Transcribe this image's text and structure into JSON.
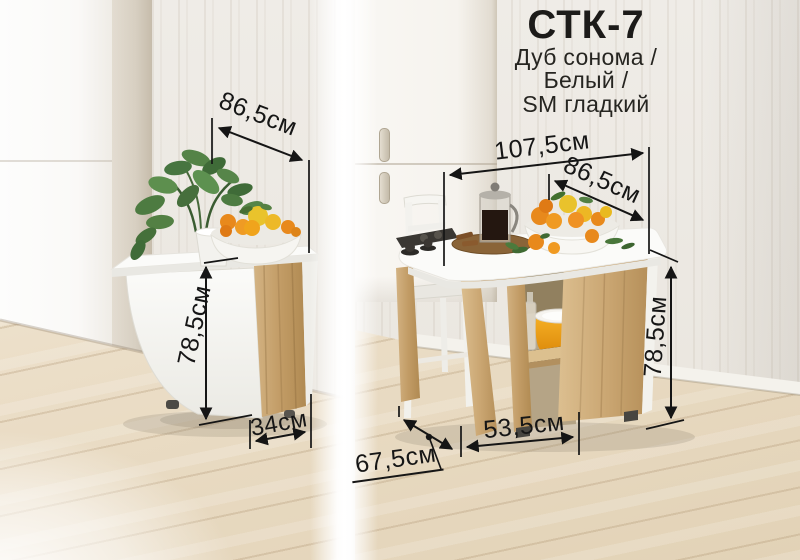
{
  "product": {
    "model": "СТК-7",
    "finish_lines": [
      "Дуб сонома /",
      "Белый /",
      "SM гладкий"
    ]
  },
  "folded_view": {
    "caption": "folded table view",
    "dim_top_width": "86,5см",
    "dim_height": "78,5см",
    "dim_base_depth": "34см"
  },
  "unfolded_view": {
    "caption": "unfolded table view",
    "dim_full_length": "107,5см",
    "dim_top_width": "86,5см",
    "dim_height": "78,5см",
    "dim_base_length": "53,5см",
    "dim_depth": "67,5см"
  },
  "colors": {
    "annotation": "#161616",
    "oak_sonoma": "#c9a76f",
    "tabletop_white": "#fafaf8",
    "wall": "#edeae4",
    "floor": "#e9dcc6",
    "pot_yellow": "#f0a41c"
  }
}
